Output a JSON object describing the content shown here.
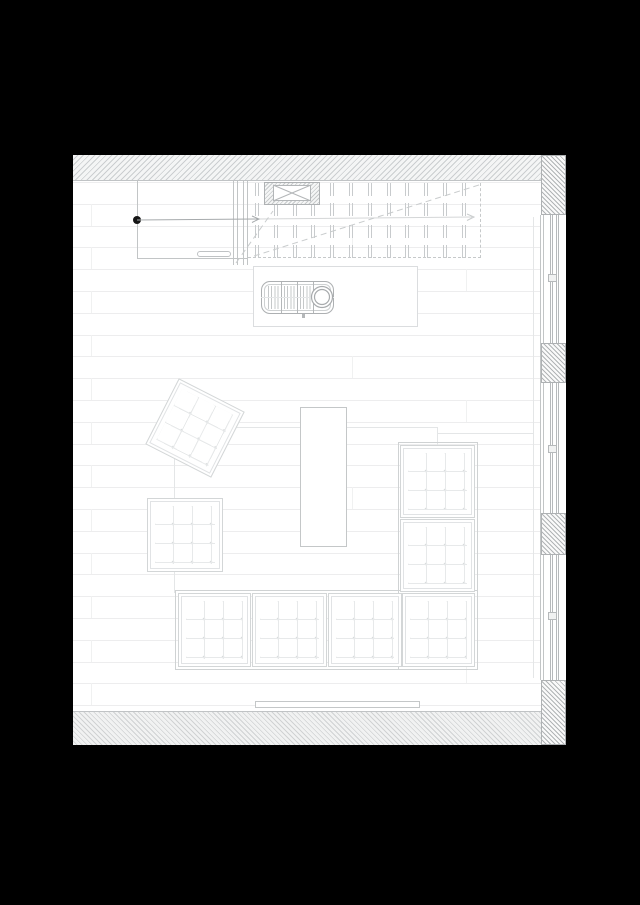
{
  "document": {
    "kind": "architectural-floor-plan",
    "subject": "living room plan: sectional sofa, ottomans, coffee table, wood stove on hearth, stair with up arrow, glazed window wall"
  },
  "colors": {
    "page_bg": "#000000",
    "sheet_bg": "#ffffff",
    "wall_line": "#c2c5c6",
    "furniture_line": "#c4c7c8",
    "floor_line": "#ededee",
    "stair_dash": "#c6c9ca",
    "arrow": "#a6aaac",
    "arrow_faint": "#d4d6d7",
    "dot": "#161616"
  },
  "sheet": {
    "x": 73,
    "y": 155,
    "w": 493,
    "h": 590
  },
  "floor": {
    "x": 0,
    "y": 27,
    "w": 468,
    "rows": 25,
    "step": 21.8,
    "joints": [
      {
        "x": 18,
        "rows": [
          1,
          3,
          5,
          7,
          9,
          11,
          13,
          15,
          17,
          19,
          21,
          23
        ]
      },
      {
        "x": 279,
        "rows": [
          2,
          8,
          14,
          20
        ]
      },
      {
        "x": 393,
        "rows": [
          4,
          10,
          16,
          22
        ]
      }
    ]
  },
  "walls": [
    {
      "name": "wall-top",
      "x": 0,
      "y": 0,
      "w": 493,
      "h": 26,
      "style": "hatch-light",
      "edge": "edge-bottom"
    },
    {
      "name": "wall-bottom",
      "x": 0,
      "y": 556,
      "w": 493,
      "h": 34,
      "style": "hatch-bottom",
      "edge": "edge-top"
    },
    {
      "name": "wall-corner-top-right",
      "x": 468,
      "y": 0,
      "w": 25,
      "h": 60,
      "style": "hatch-dark",
      "edge": "blk"
    },
    {
      "name": "wall-pier-1",
      "x": 468,
      "y": 188,
      "w": 25,
      "h": 40,
      "style": "hatch-dark",
      "edge": "blk"
    },
    {
      "name": "wall-pier-2",
      "x": 468,
      "y": 358,
      "w": 25,
      "h": 42,
      "style": "hatch-dark",
      "edge": "blk"
    },
    {
      "name": "wall-corner-bottom-right",
      "x": 468,
      "y": 525,
      "w": 25,
      "h": 65,
      "style": "hatch-dark",
      "edge": "blk"
    }
  ],
  "window_wall": {
    "sill_line": {
      "x": 460,
      "y": 62,
      "w": 1,
      "h": 461
    },
    "face_line": {
      "x": 467,
      "y": 60,
      "w": 1,
      "h": 465
    },
    "segments": [
      {
        "name": "window-1",
        "x": 470,
        "y": 60,
        "w": 22,
        "h": 128,
        "glz": [
          6,
          12
        ],
        "mullion_y": 59
      },
      {
        "name": "window-2",
        "x": 470,
        "y": 228,
        "w": 22,
        "h": 130,
        "glz": [
          6,
          12
        ],
        "mullion_y": 62
      },
      {
        "name": "window-3",
        "x": 470,
        "y": 400,
        "w": 22,
        "h": 125,
        "glz": [
          6,
          12
        ],
        "mullion_y": 57
      }
    ]
  },
  "entry": {
    "lines": [
      {
        "x": 64,
        "y": 25,
        "w": 1,
        "h": 79
      },
      {
        "x": 64,
        "y": 103,
        "w": 110,
        "h": 1
      },
      {
        "x": 160,
        "y": 25,
        "w": 1,
        "h": 85
      },
      {
        "x": 164,
        "y": 25,
        "w": 1,
        "h": 85
      },
      {
        "x": 170,
        "y": 25,
        "w": 1,
        "h": 85
      },
      {
        "x": 174,
        "y": 25,
        "w": 1,
        "h": 85
      }
    ],
    "bench": {
      "x": 124,
      "y": 96,
      "w": 34,
      "h": 6
    },
    "dot": {
      "x": 60,
      "y": 61,
      "w": 8,
      "h": 8
    }
  },
  "stair": {
    "edges": [
      {
        "x": 175,
        "y": 102,
        "w": 233,
        "h": 0,
        "type": "dash-h"
      },
      {
        "x": 407,
        "y": 28,
        "w": 0,
        "h": 75,
        "type": "dash-v"
      }
    ],
    "cols": {
      "x0": 182,
      "step": 18.8,
      "count": 12
    },
    "bands": [
      {
        "y": 28,
        "h": 13
      },
      {
        "y": 48,
        "h": 13
      },
      {
        "y": 70,
        "h": 13
      },
      {
        "y": 90,
        "h": 13
      }
    ]
  },
  "chimney": {
    "outer": {
      "x": 191,
      "y": 27,
      "w": 56,
      "h": 23
    },
    "inner": {
      "x": 200,
      "y": 30,
      "w": 38,
      "h": 16
    }
  },
  "stove": {
    "hearth": {
      "x": 180,
      "y": 111,
      "w": 165,
      "h": 61
    },
    "body": {
      "x": 188,
      "y": 126,
      "w": 73,
      "h": 33
    },
    "ribs": {
      "x": 195,
      "y": 131,
      "w": 45,
      "h": 23
    },
    "dividers": [
      208,
      224,
      240
    ],
    "divider_span": {
      "y": 127,
      "h": 31
    },
    "centerline": {
      "x": 188,
      "y": 142,
      "w": 73,
      "h": 1
    },
    "flue": {
      "cx": 249,
      "cy": 142,
      "r": 10.5,
      "r2": 7.5
    },
    "tick": {
      "x": 229,
      "y": 159,
      "w": 3,
      "h": 4
    }
  },
  "rug": {
    "lines": [
      {
        "x": 101,
        "y": 272,
        "w": 263,
        "h": 1,
        "cls": "ln-faint"
      },
      {
        "x": 101,
        "y": 272,
        "w": 1,
        "h": 166,
        "cls": "ln-faint"
      },
      {
        "x": 364,
        "y": 272,
        "w": 1,
        "h": 18,
        "cls": "ln-faint"
      },
      {
        "x": 364,
        "y": 278,
        "w": 96,
        "h": 1,
        "cls": "ln-faint"
      }
    ]
  },
  "furniture": [
    {
      "name": "sofa-frame-right",
      "type": "frame",
      "x": 325,
      "y": 287,
      "w": 80,
      "h": 228
    },
    {
      "name": "sofa-frame-bottom",
      "type": "frame",
      "x": 102,
      "y": 435,
      "w": 303,
      "h": 80
    },
    {
      "name": "ottoman-rotated",
      "type": "cushion",
      "x": 85,
      "y": 236,
      "w": 74,
      "h": 74,
      "rot": 27
    },
    {
      "name": "ottoman-square",
      "type": "cushion",
      "x": 74,
      "y": 343,
      "w": 76,
      "h": 74
    },
    {
      "name": "coffee-table",
      "type": "outline",
      "x": 227,
      "y": 252,
      "w": 47,
      "h": 140
    },
    {
      "name": "sofa-module-right-1",
      "type": "cushion",
      "x": 327,
      "y": 290,
      "w": 75,
      "h": 73
    },
    {
      "name": "sofa-module-right-2",
      "type": "cushion",
      "x": 327,
      "y": 364,
      "w": 75,
      "h": 73
    },
    {
      "name": "sofa-module-corner",
      "type": "cushion",
      "x": 329,
      "y": 438,
      "w": 73,
      "h": 74
    },
    {
      "name": "sofa-module-bottom-1",
      "type": "cushion",
      "x": 105,
      "y": 438,
      "w": 73,
      "h": 74
    },
    {
      "name": "sofa-module-bottom-2",
      "type": "cushion",
      "x": 179,
      "y": 438,
      "w": 75,
      "h": 74
    },
    {
      "name": "sofa-module-bottom-3",
      "type": "cushion",
      "x": 255,
      "y": 438,
      "w": 74,
      "h": 74
    },
    {
      "name": "radiator",
      "type": "outline",
      "x": 182,
      "y": 546,
      "w": 165,
      "h": 7
    }
  ],
  "overlay": {
    "lines": [
      {
        "name": "stair-up-arrow-line",
        "x1": 64,
        "y1": 65,
        "x2": 185,
        "y2": 64,
        "stroke": "#a6aaac",
        "w": 1
      },
      {
        "name": "stair-up-arrow-line-faint",
        "x1": 185,
        "y1": 64,
        "x2": 399,
        "y2": 62,
        "stroke": "#d4d6d7",
        "w": 1
      },
      {
        "name": "chimney-x-1",
        "x1": 200,
        "y1": 30,
        "x2": 238,
        "y2": 46,
        "stroke": "#b3b6b8",
        "w": 1
      },
      {
        "name": "chimney-x-2",
        "x1": 200,
        "y1": 46,
        "x2": 238,
        "y2": 30,
        "stroke": "#b3b6b8",
        "w": 1
      },
      {
        "name": "flue-x-1",
        "x1": 243.7,
        "y1": 136.7,
        "x2": 254.3,
        "y2": 147.3,
        "stroke": "#a8abad",
        "w": 1
      },
      {
        "name": "flue-x-2",
        "x1": 243.7,
        "y1": 147.3,
        "x2": 254.3,
        "y2": 136.7,
        "stroke": "#a8abad",
        "w": 1
      }
    ],
    "dashes": [
      {
        "name": "stair-break-long",
        "x1": 181,
        "y1": 101,
        "x2": 409,
        "y2": 29
      },
      {
        "name": "stair-break-short",
        "x1": 163,
        "y1": 108,
        "x2": 200,
        "y2": 56
      }
    ],
    "heads": [
      {
        "name": "arrow-head-mid",
        "pts": "179,61 186,64 179,67.5",
        "stroke": "#a6aaac"
      },
      {
        "name": "arrow-head-end",
        "pts": "394,59 401,62 394,65.5",
        "stroke": "#c9cccd"
      }
    ],
    "circles": [
      {
        "name": "flue-circle-outer",
        "cx": 249,
        "cy": 142,
        "r": 10.5,
        "stroke": "#a8abad",
        "fill": "#ffffff"
      },
      {
        "name": "flue-circle-inner",
        "cx": 249,
        "cy": 142,
        "r": 7.5,
        "stroke": "#a8abad",
        "fill": "none"
      }
    ]
  }
}
